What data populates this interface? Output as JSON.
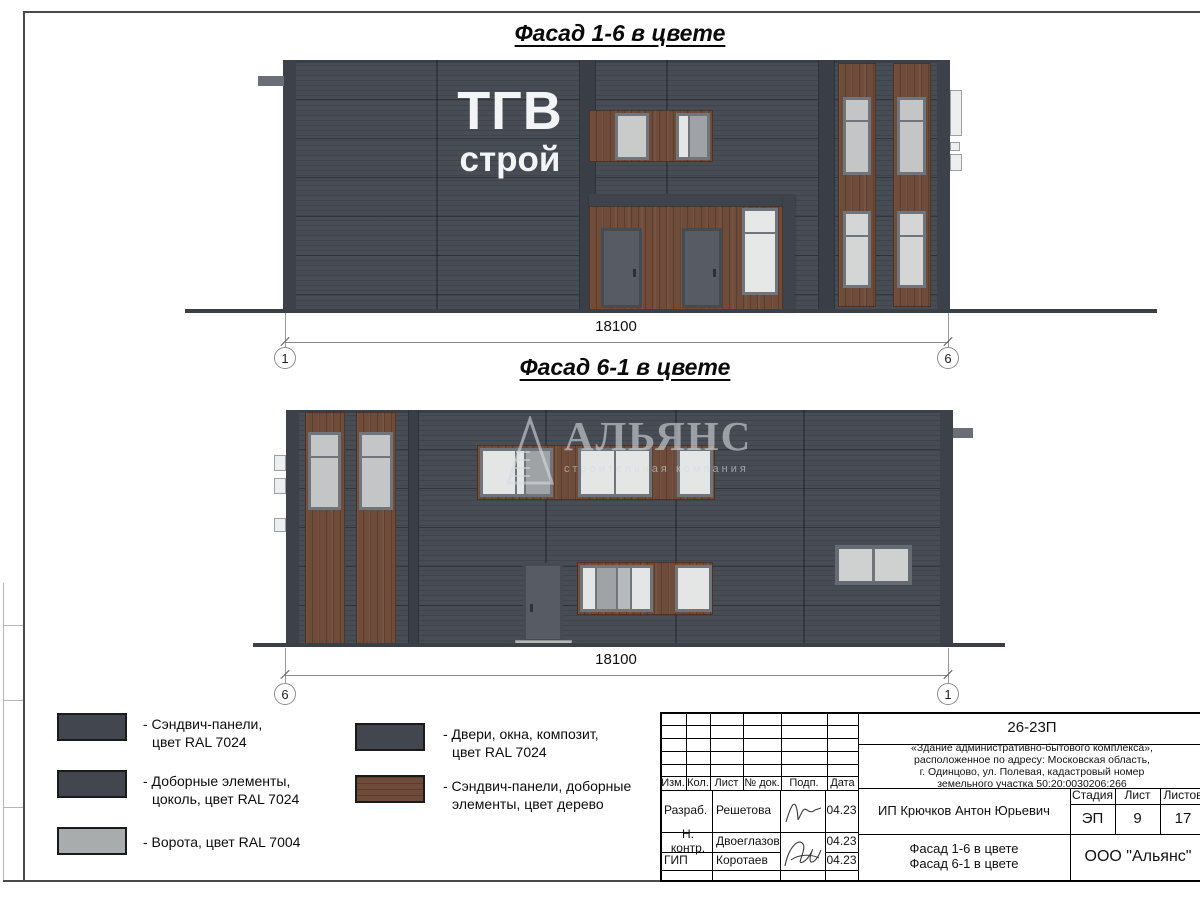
{
  "facade1": {
    "title": "Фасад 1-6 в цвете",
    "logo_line1": "ТГВ",
    "logo_line2": "строй",
    "dimension": "18100",
    "axis_left": "1",
    "axis_right": "6"
  },
  "facade2": {
    "title": "Фасад 6-1 в цвете",
    "dimension": "18100",
    "axis_left": "6",
    "axis_right": "1",
    "watermark_title": "АЛЬЯНС",
    "watermark_subtitle": "строительная компания"
  },
  "legend": {
    "items": [
      {
        "line1": "- Сэндвич-панели,",
        "line2": "цвет RAL 7024"
      },
      {
        "line1": "- Доборные элементы,",
        "line2": "цоколь, цвет RAL 7024"
      },
      {
        "line1": "- Ворота, цвет RAL 7004",
        "line2": ""
      },
      {
        "line1": "- Двери, окна, композит,",
        "line2": "цвет RAL 7024"
      },
      {
        "line1": "- Сэндвич-панели, доборные",
        "line2": "элементы, цвет дерево"
      }
    ]
  },
  "titleblock": {
    "code": "26-23П",
    "description_line1": "«Здание административно-бытового комплекса»,",
    "description_line2": "расположенное по адресу: Московская область,",
    "description_line3": "г. Одинцово, ул. Полевая, кадастровый номер",
    "description_line4": "земельного участка 50:20:0030206:266",
    "cols": {
      "c1": "Изм.",
      "c2": "Кол.",
      "c3": "Лист",
      "c4": "№ док.",
      "c5": "Подп.",
      "c6": "Дата"
    },
    "row1": {
      "role": "Разраб.",
      "name": "Решетова",
      "date": "04.23"
    },
    "row2": {
      "role": "Н. контр.",
      "name": "Двоеглазов",
      "date": "04.23"
    },
    "row3": {
      "role": "ГИП",
      "name": "Коротаев",
      "date": "04.23"
    },
    "client": "ИП Крючков Антон Юрьевич",
    "stage_label": "Стадия",
    "sheet_label": "Лист",
    "sheets_label": "Листов",
    "stage_value": "ЭП",
    "sheet_value": "9",
    "sheets_value": "17",
    "subject_line1": "Фасад 1-6 в цвете",
    "subject_line2": "Фасад 6-1 в цвете",
    "company": "ООО \"Альянс\""
  },
  "colors": {
    "panel_ral7024": "#474C55",
    "trim_dark": "#3A3F47",
    "wood": "#6F4B3A",
    "gate_ral7004": "#A9ACAC",
    "glass": "#C9CACA",
    "door": "#575C64"
  }
}
